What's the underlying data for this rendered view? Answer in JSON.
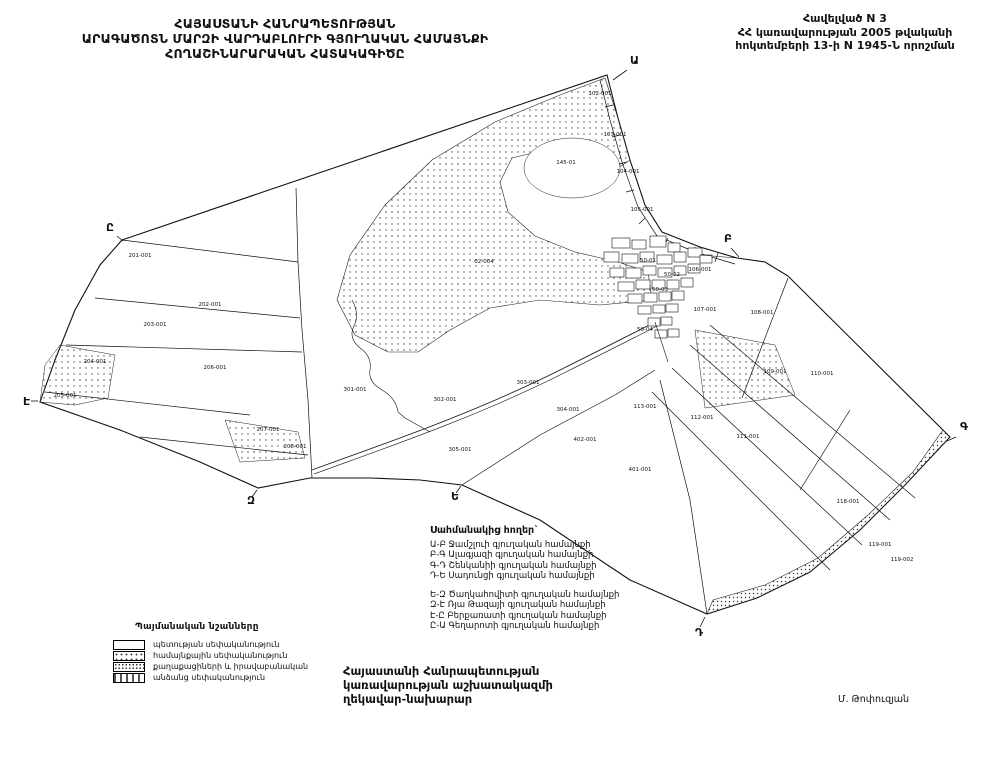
{
  "title_block": {
    "line1": "ՀԱՅԱՍՏԱՆԻ ՀԱՆՐԱՊԵՏՈՒԹՅԱՆ",
    "line2": "ԱՐԱԳԱԾՈՏՆ ՄԱՐԶԻ ՎԱՐԴԱԲԼՈՒՐԻ ԳՅՈՒՂԱԿԱՆ ՀԱՄԱՅՆՔԻ",
    "line3": "ՀՈՂԱՇԻՆԱՐԱՐԱԿԱՆ ՀԱՏԱԿԱԳԻԾԸ"
  },
  "annex_block": {
    "line1": "Հավելված N 3",
    "line2": "ՀՀ կառավարության 2005 թվականի",
    "line3": "հոկտեմբերի 13-ի N 1945-Ն որոշման"
  },
  "adjacent_lands": {
    "title": "Սահմանակից հողեր`",
    "group1": [
      "Ա-Բ  Ջամշլուի գյուղական համայնքի",
      "Բ-Գ  Ալագյազի գյուղական համայնքի",
      "Գ-Դ  Շենկանիի գյուղական համայնքի",
      "Դ-Ե  Սադունցի գյուղական համայնքի"
    ],
    "group2": [
      "Ե-Զ  Ծաղկահովիտի գյուղական համայնքի",
      "Զ-Է  Ռյա Թազայի գյուղական համայնքի",
      "Է-Ը  Բերքառատի գյուղական համայնքի",
      "Ը-Ա  Գեղարոտի գյուղական համայնքի"
    ]
  },
  "conventional_signs": {
    "title": "Պայմանական նշանները",
    "items": [
      {
        "pattern": "plain",
        "label": "պետության սեփականություն"
      },
      {
        "pattern": "dots",
        "label": "համայնքային սեփականություն"
      },
      {
        "pattern": "dots-dense",
        "label": "քաղաքացիների և իրավաբանական"
      },
      {
        "pattern": "dashes",
        "label": "անձանց սեփականություն"
      }
    ]
  },
  "footer": {
    "line1": "Հայաստանի Հանրապետության",
    "line2": "կառավարության աշխատակազմի",
    "line3": "ղեկավար-նախարար",
    "signature": "Մ. Թոփուզյան"
  },
  "map": {
    "corner_letters": [
      {
        "label": "Ա",
        "x": 630,
        "y": 64,
        "ax1": 627,
        "ay1": 70,
        "ax2": 613,
        "ay2": 80
      },
      {
        "label": "Բ",
        "x": 724,
        "y": 242,
        "ax1": 731,
        "ay1": 248,
        "ax2": 739,
        "ay2": 257
      },
      {
        "label": "Գ",
        "x": 960,
        "y": 430,
        "ax1": 956,
        "ay1": 437,
        "ax2": 947,
        "ay2": 441
      },
      {
        "label": "Դ",
        "x": 695,
        "y": 636,
        "ax1": 700,
        "ay1": 627,
        "ax2": 705,
        "ay2": 617
      },
      {
        "label": "Ե",
        "x": 451,
        "y": 500,
        "ax1": 456,
        "ay1": 493,
        "ax2": 461,
        "ay2": 486
      },
      {
        "label": "Զ",
        "x": 247,
        "y": 504,
        "ax1": 252,
        "ay1": 497,
        "ax2": 257,
        "ay2": 490
      },
      {
        "label": "Է",
        "x": 23,
        "y": 405,
        "ax1": 31,
        "ay1": 401,
        "ax2": 38,
        "ay2": 401
      },
      {
        "label": "Ը",
        "x": 106,
        "y": 231,
        "ax1": 117,
        "ay1": 236,
        "ax2": 123,
        "ay2": 241
      }
    ],
    "parcel_labels": [
      {
        "t": "102-001",
        "x": 600,
        "y": 95
      },
      {
        "t": "103-001",
        "x": 615,
        "y": 136
      },
      {
        "t": "104-001",
        "x": 628,
        "y": 173
      },
      {
        "t": "105-001",
        "x": 642,
        "y": 211
      },
      {
        "t": "145-01",
        "x": 566,
        "y": 164
      },
      {
        "t": "02-004",
        "x": 484,
        "y": 263
      },
      {
        "t": "106-001",
        "x": 700,
        "y": 271
      },
      {
        "t": "201-001",
        "x": 140,
        "y": 257
      },
      {
        "t": "202-001",
        "x": 210,
        "y": 306
      },
      {
        "t": "203-001",
        "x": 155,
        "y": 326
      },
      {
        "t": "204-001",
        "x": 95,
        "y": 363
      },
      {
        "t": "205-001",
        "x": 65,
        "y": 397
      },
      {
        "t": "206-001",
        "x": 215,
        "y": 369
      },
      {
        "t": "207-001",
        "x": 268,
        "y": 431
      },
      {
        "t": "208-001",
        "x": 295,
        "y": 448
      },
      {
        "t": "301-001",
        "x": 355,
        "y": 391
      },
      {
        "t": "302-001",
        "x": 445,
        "y": 401
      },
      {
        "t": "303-001",
        "x": 528,
        "y": 384
      },
      {
        "t": "304-001",
        "x": 568,
        "y": 411
      },
      {
        "t": "305-001",
        "x": 460,
        "y": 451
      },
      {
        "t": "107-001",
        "x": 705,
        "y": 311
      },
      {
        "t": "108-001",
        "x": 762,
        "y": 314
      },
      {
        "t": "109-001",
        "x": 775,
        "y": 373
      },
      {
        "t": "110-001",
        "x": 822,
        "y": 375
      },
      {
        "t": "111-001",
        "x": 748,
        "y": 438
      },
      {
        "t": "112-001",
        "x": 702,
        "y": 419
      },
      {
        "t": "113-001",
        "x": 645,
        "y": 408
      },
      {
        "t": "118-001",
        "x": 848,
        "y": 503
      },
      {
        "t": "119-001",
        "x": 880,
        "y": 546
      },
      {
        "t": "119-002",
        "x": 902,
        "y": 561
      },
      {
        "t": "401-001",
        "x": 640,
        "y": 471
      },
      {
        "t": "402-001",
        "x": 585,
        "y": 441
      },
      {
        "t": "50-01",
        "x": 648,
        "y": 262
      },
      {
        "t": "50-02",
        "x": 672,
        "y": 276
      },
      {
        "t": "50-03",
        "x": 660,
        "y": 291
      },
      {
        "t": "50-04",
        "x": 645,
        "y": 331
      }
    ]
  },
  "colors": {
    "ink": "#111111",
    "paper": "#ffffff"
  }
}
